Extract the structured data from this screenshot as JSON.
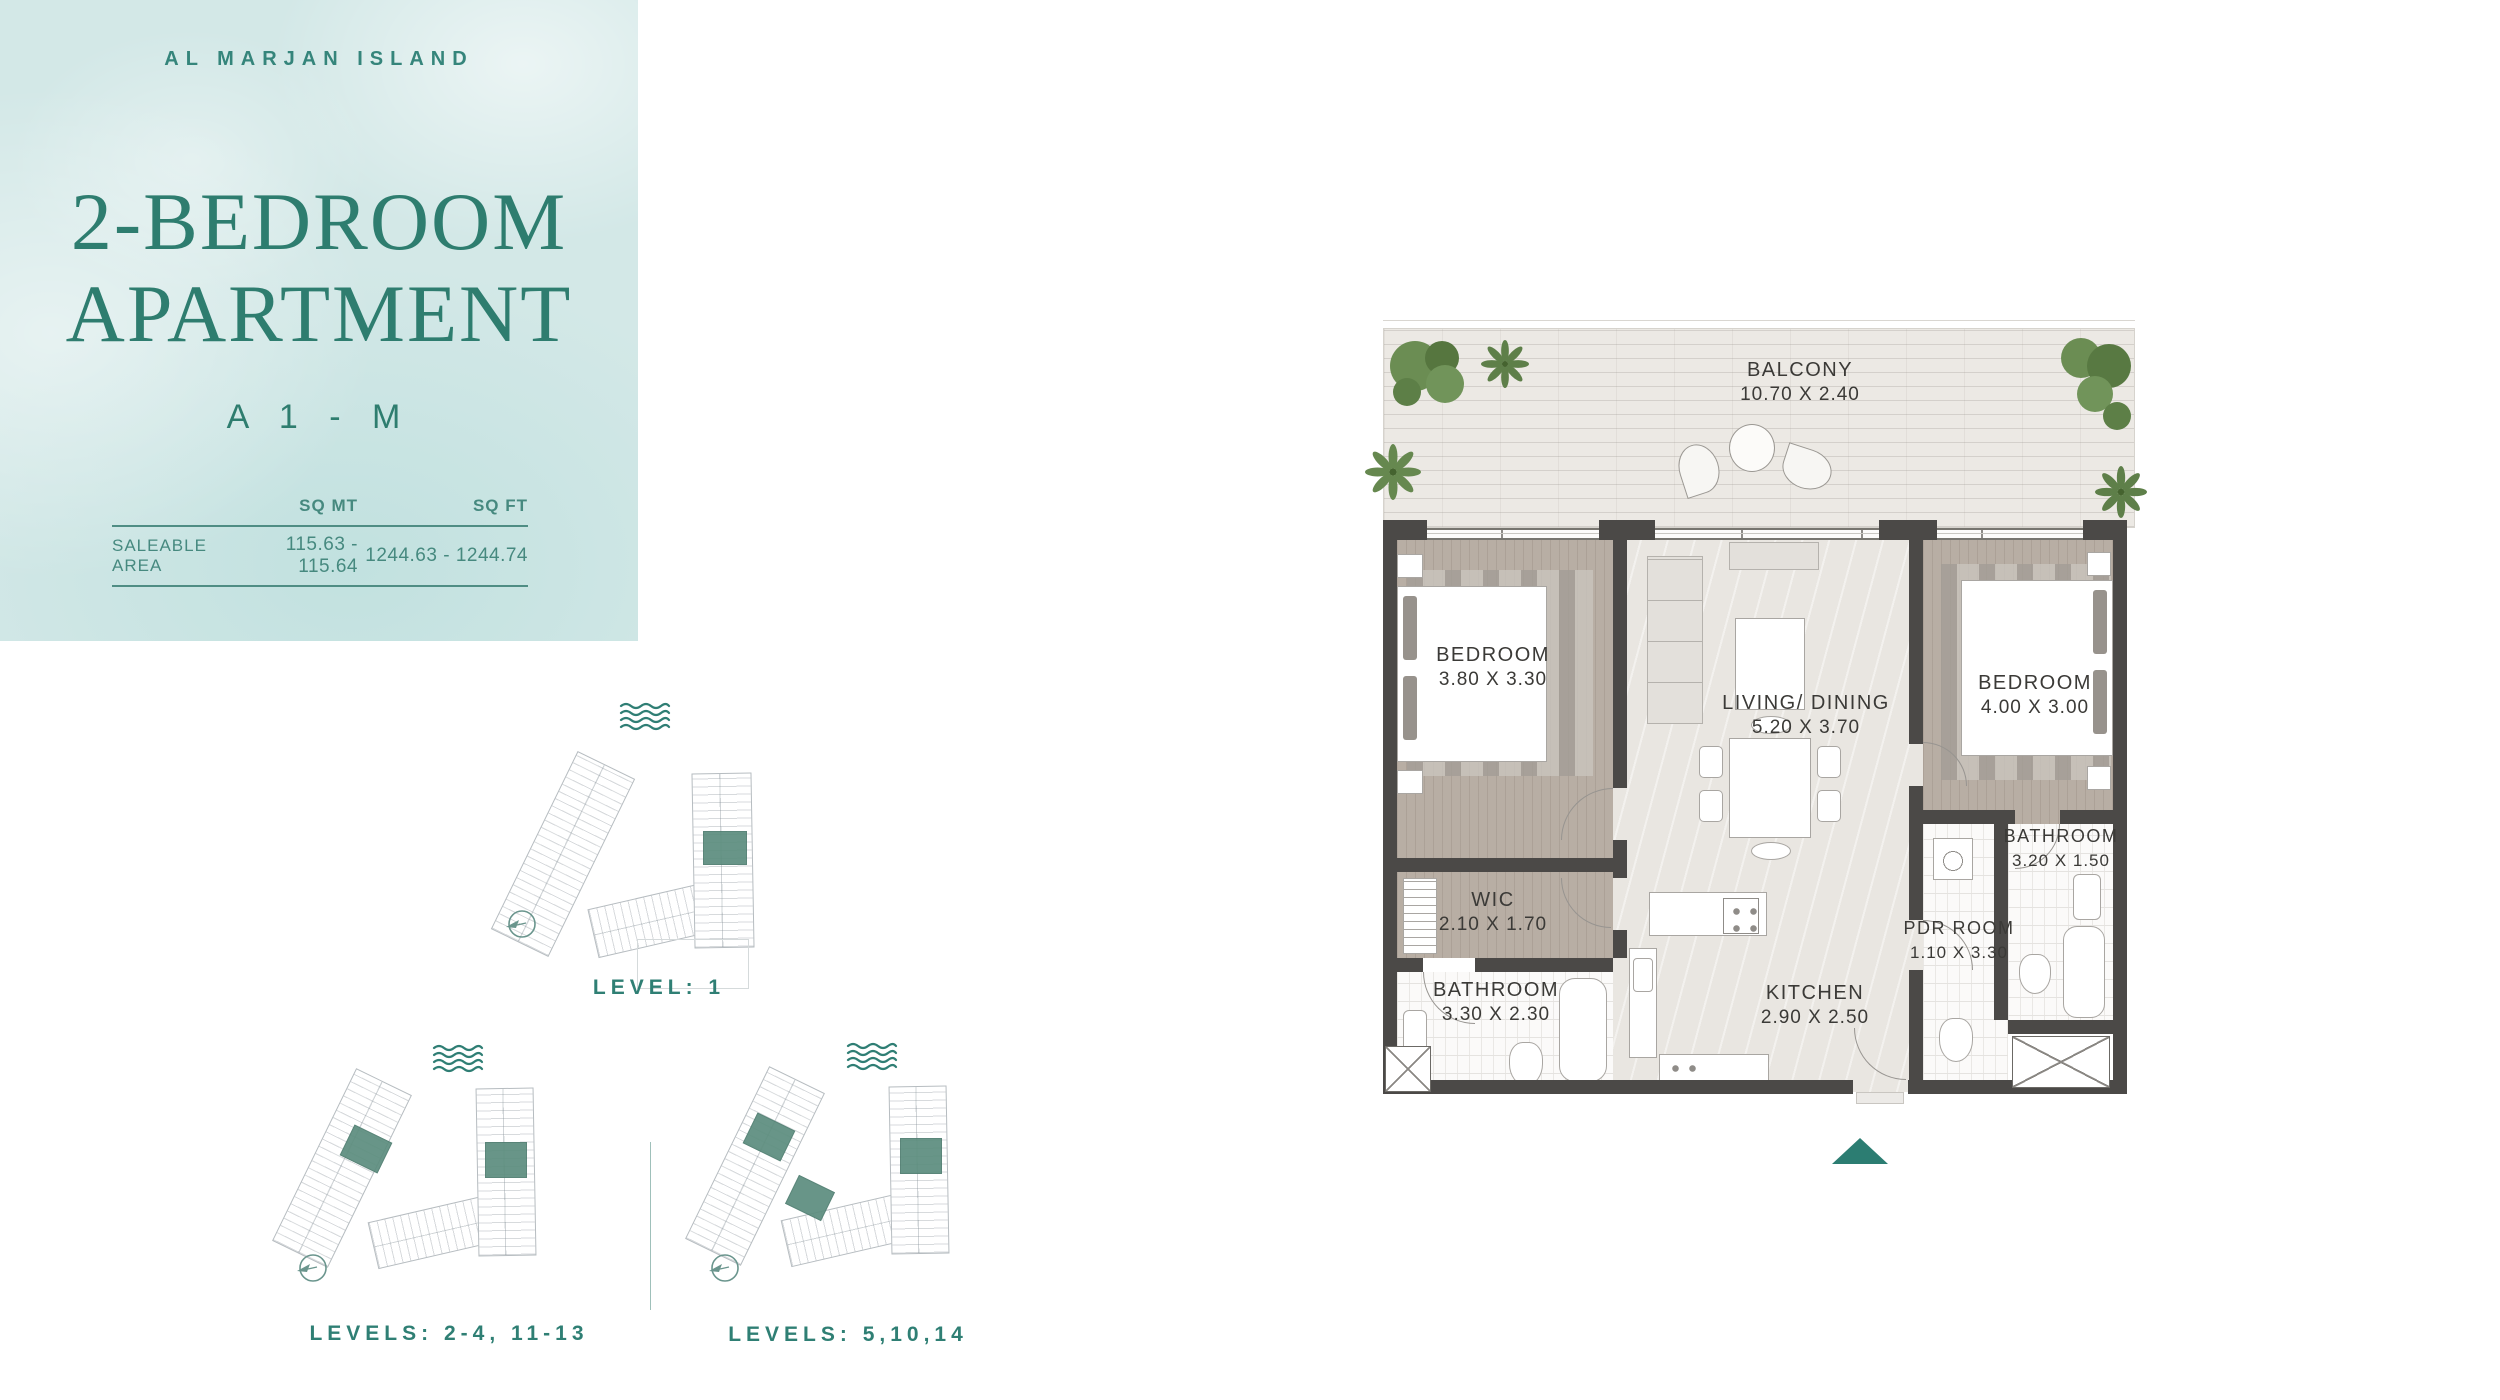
{
  "brand": {
    "location": "AL MARJAN ISLAND"
  },
  "unit": {
    "title_line1": "2-BEDROOM",
    "title_line2": "APARTMENT",
    "code": "A 1 - M"
  },
  "area_table": {
    "col_sqmt": "SQ MT",
    "col_sqft": "SQ FT",
    "row_label": "SALEABLE AREA",
    "sqmt": "115.63 - 115.64",
    "sqft": "1244.63 - 1244.74"
  },
  "levels": [
    {
      "label": "LEVEL: 1"
    },
    {
      "label": "LEVELS: 2-4, 11-13"
    },
    {
      "label": "LEVELS: 5,10,14"
    }
  ],
  "floorplan": {
    "rooms": [
      {
        "name": "BALCONY",
        "dims": "10.70 X 2.40"
      },
      {
        "name": "BEDROOM",
        "dims": "3.80 X 3.30"
      },
      {
        "name": "LIVING/ DINING",
        "dims": "5.20 X 3.70"
      },
      {
        "name": "BEDROOM",
        "dims": "4.00 X 3.00"
      },
      {
        "name": "WIC",
        "dims": "2.10 X 1.70"
      },
      {
        "name": "BATHROOM",
        "dims": "3.30 X 2.30"
      },
      {
        "name": "KITCHEN",
        "dims": "2.90 X 2.50"
      },
      {
        "name": "PDR ROOM",
        "dims": "1.10 X 3.30"
      },
      {
        "name": "BATHROOM",
        "dims": "3.20 X 1.50"
      }
    ]
  },
  "icons": {
    "waves": "water-waves",
    "compass": "north-compass",
    "entry_arrow": "entry-direction-triangle",
    "tree": "shrub-cluster",
    "palm": "palm-top"
  },
  "colors": {
    "accent_teal": "#2e7d6f",
    "panel_bg": "#d3e8e7",
    "unit_highlight": "#5c8d7e",
    "wall": "#4b4947",
    "wood_floor": "#b8aea4",
    "living_floor": "#e9e6e1",
    "tile_floor": "#fbfaf9",
    "deck": "#ece9e4"
  }
}
